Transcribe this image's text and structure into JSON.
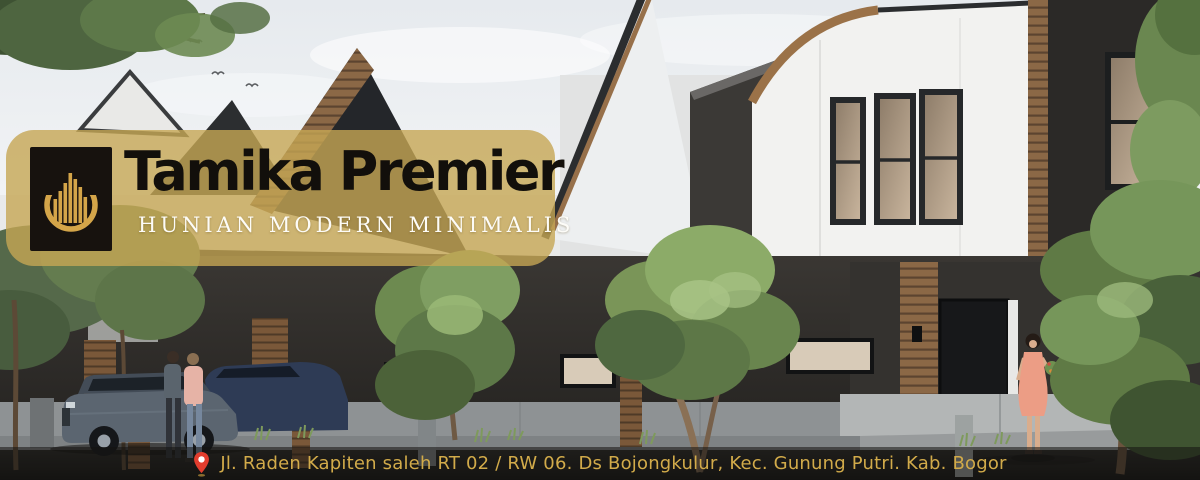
{
  "brand": {
    "title": "Tamika Premier",
    "tagline": "HUNIAN MODERN MINIMALIS",
    "logo_icon": "building-crescent-icon"
  },
  "address_bar": {
    "icon": "location-pin-icon",
    "text": "Jl. Raden Kapiten saleh RT 02 / RW 06. Ds Bojongkulur, Kec. Gunung Putri. Kab. Bogor"
  },
  "colors": {
    "badge_overlay_gold": "#c6a654",
    "title_text": "#120f0b",
    "tagline_text": "#ffffff",
    "logo_background": "#17120e",
    "logo_gold": "#d4a549",
    "address_text_gold": "#d2ab4a",
    "address_bar_background": "#1c1b18",
    "pin_red": "#e23d2e"
  },
  "hero_image": {
    "description": "3D architectural render of a row of modern minimalist two-storey townhouses: black gable roofs, white upper facades, dark textured lower walls, wood-slat accents, letterbox windows, landscaped shrubs and trees, a grey SUV, two residents on the driveway and a woman in a coral dress leaving a doorway"
  }
}
